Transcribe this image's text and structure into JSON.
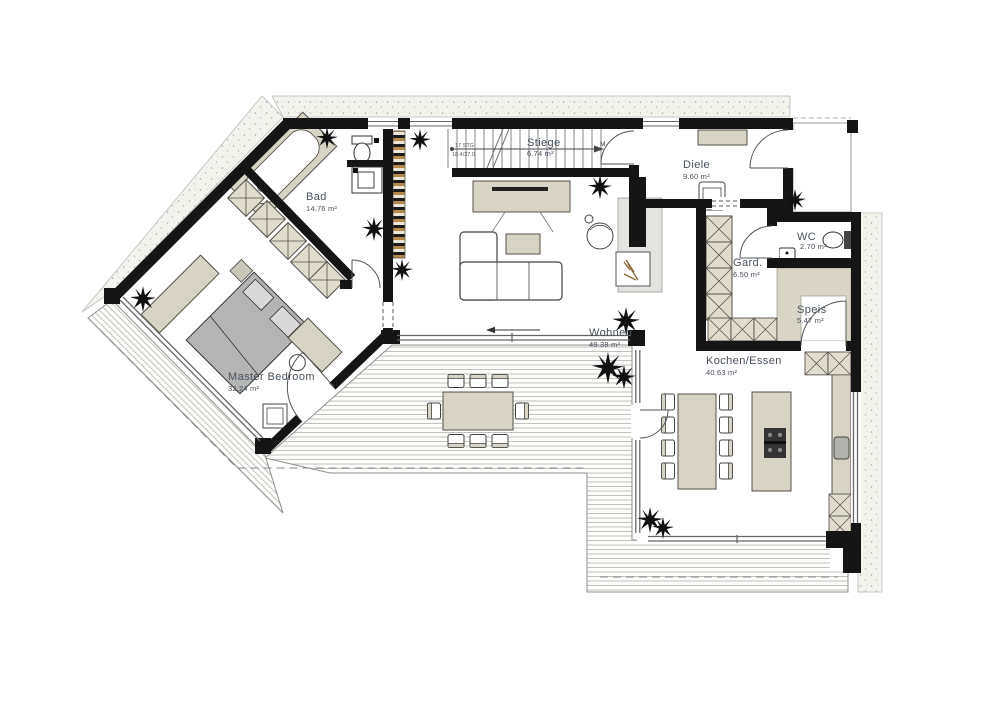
{
  "plan": {
    "rooms": [
      {
        "name": "Bad",
        "area": "14.76 m²"
      },
      {
        "name": "Stiege",
        "area": "6.74 m²"
      },
      {
        "name": "Diele",
        "area": "9.60 m²"
      },
      {
        "name": "WC",
        "area": "2.70 m²"
      },
      {
        "name": "Gard.",
        "area": "6.50 m²"
      },
      {
        "name": "Speis",
        "area": "5.47 m²"
      },
      {
        "name": "Wohnen",
        "area": "49.38 m²"
      },
      {
        "name": "Kochen/Essen",
        "area": "40.63 m²"
      },
      {
        "name": "Master Bedroom",
        "area": "32.24 m²"
      }
    ],
    "stairs": {
      "steps": "17 STG",
      "dimension": "18.4/27.0",
      "marker": "M"
    },
    "colors": {
      "wall": "#151515",
      "furniture": "#d7d3c5",
      "bed": "#b4b4b4",
      "label_text": "#46505b",
      "deck_line": "#9c9c98",
      "gravel_bg": "#f4f4ef",
      "wood_stripe": "#b58a4e"
    }
  }
}
